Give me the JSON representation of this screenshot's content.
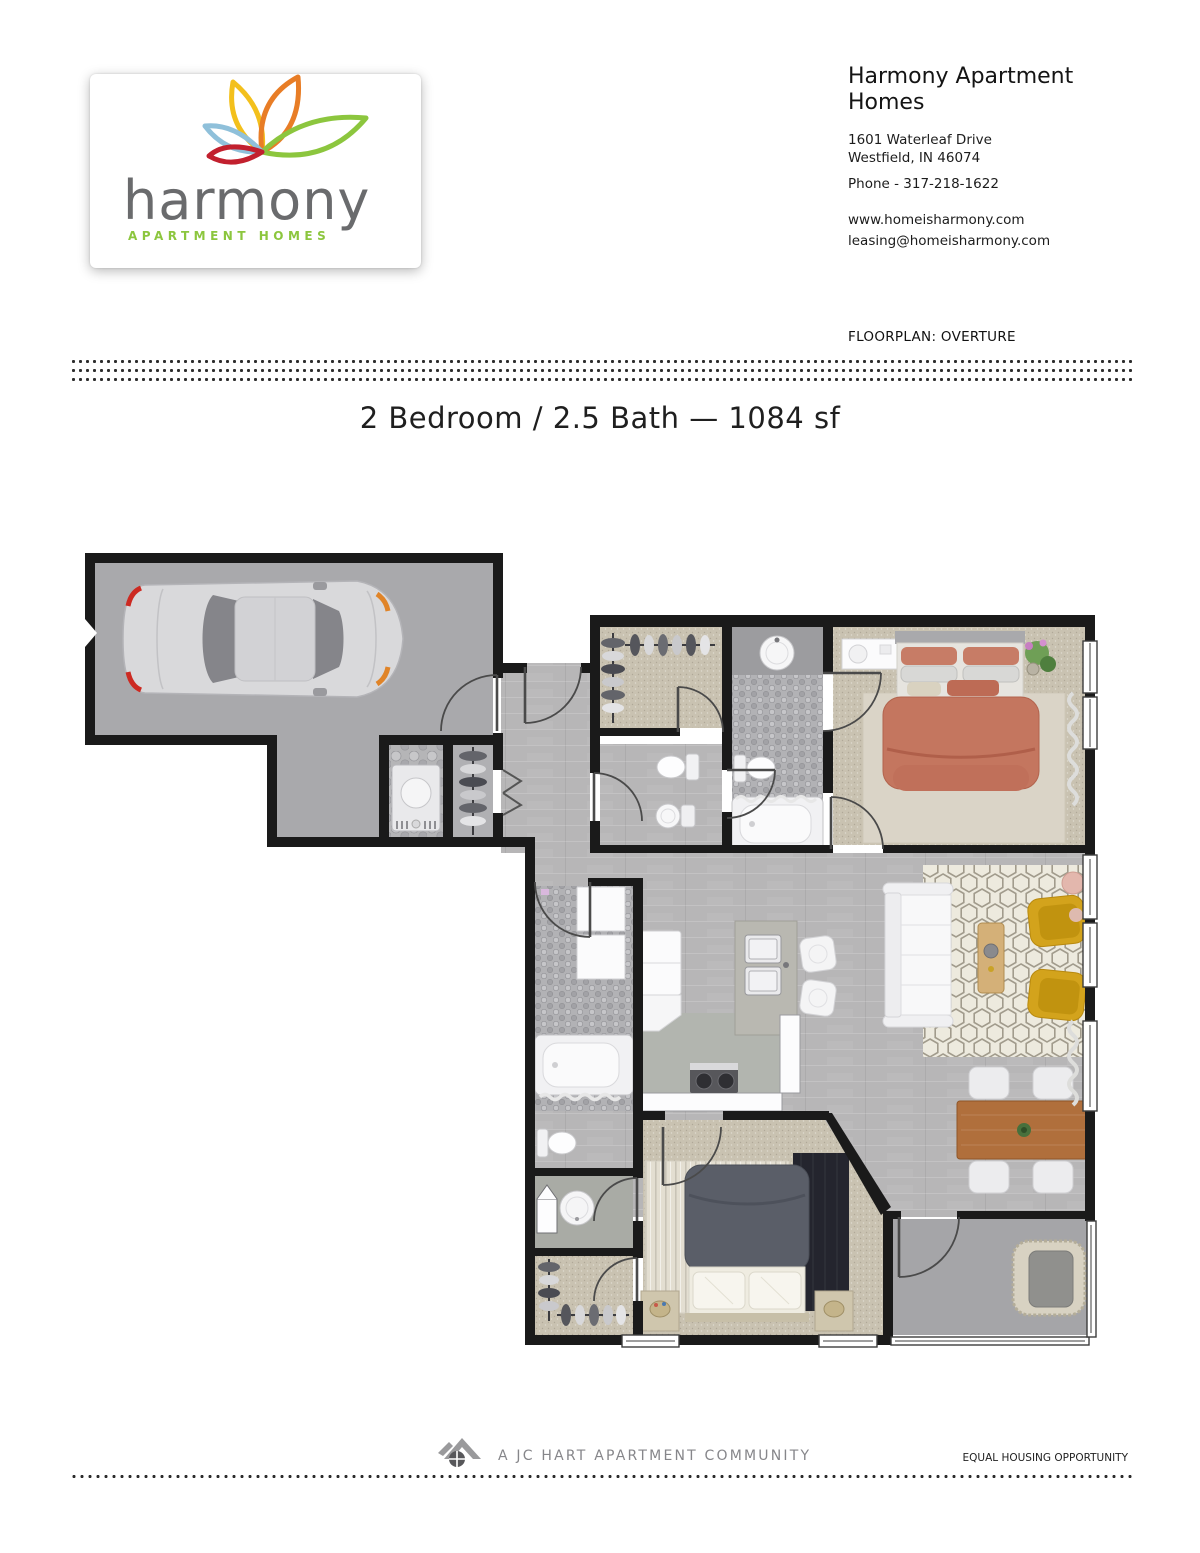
{
  "brand": {
    "name": "harmony",
    "tagline": "APARTMENT HOMES"
  },
  "contact": {
    "company": "Harmony Apartment Homes",
    "address_line1": "1601 Waterleaf Drive",
    "address_line2": "Westfield, IN 46074",
    "phone": "Phone - 317-218-1622",
    "website": "www.homeisharmony.com",
    "email": "leasing@homeisharmony.com"
  },
  "floorplan": {
    "label": "FLOORPLAN: OVERTURE",
    "name": "OVERTURE",
    "title": "2 Bedroom / 2.5 Bath — 1084 sf",
    "bedrooms": 2,
    "bathrooms": 2.5,
    "square_feet": 1084,
    "rooms": [
      "garage",
      "laundry",
      "coat-closet",
      "entry",
      "walk-in-closet-1",
      "powder-room",
      "bathroom-1",
      "bedroom-1",
      "kitchen",
      "living-room",
      "dining-area",
      "bathroom-2",
      "half-bath",
      "bedroom-2",
      "walk-in-closet-2",
      "patio"
    ]
  },
  "footer": {
    "community": "A JC HART APARTMENT COMMUNITY",
    "equal_housing": "EQUAL HOUSING OPPORTUNITY"
  },
  "colors": {
    "logo_yellow": "#f3c01c",
    "logo_orange": "#e87d26",
    "logo_green": "#8cc63e",
    "logo_blue": "#8fc0da",
    "logo_red": "#c2202e",
    "brand_text": "#6a6b6d",
    "walls": "#1a1a1a",
    "bed_coral": "#c4765f",
    "chair_yellow": "#d3a31c",
    "table_wood": "#b06f3c"
  }
}
